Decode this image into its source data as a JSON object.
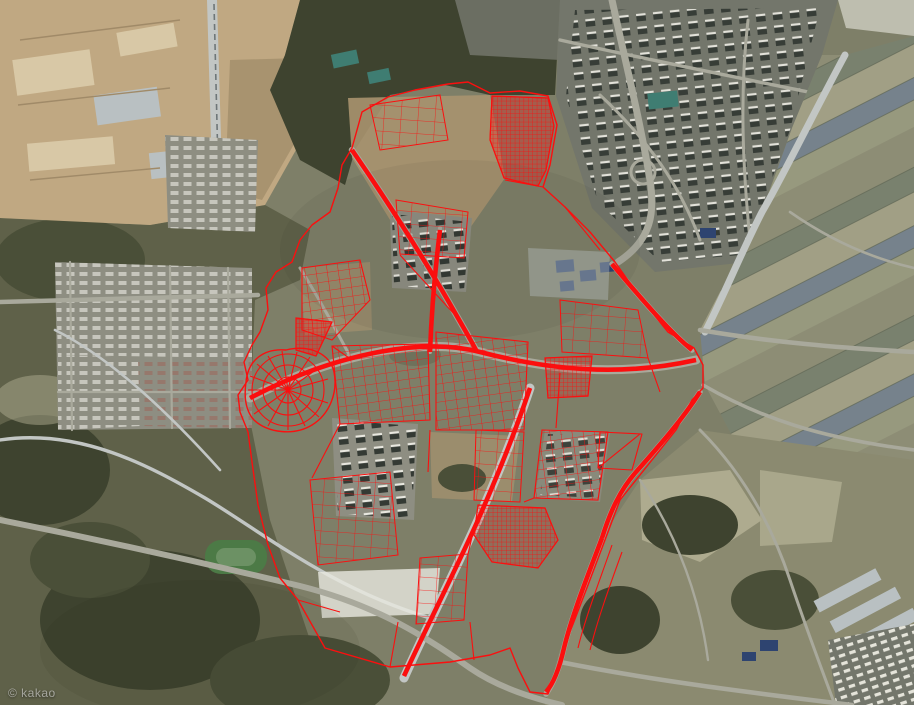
{
  "map": {
    "view_type": "satellite-aerial",
    "watermark": "© kakao",
    "description": "Satellite map of a Korean new-town development district with a red cadastral parcel-boundary overlay",
    "zoom_scale_px": [
      914,
      705
    ],
    "colors": {
      "base": "#7e7f68",
      "forest": "#3e432f",
      "forest2": "#4a4f38",
      "rural": "#5f6149",
      "dirt": "#c0a882",
      "dirt_light": "#d8c8a6",
      "pad_gray": "#b9c0c2",
      "dirt_deep": "#a8936f",
      "urban": "#73766b",
      "urban_light": "#8e8e82",
      "road": "#a9a99c",
      "road_light": "#c2c6c4",
      "field": "#8d8d75",
      "field_dark": "#79816e",
      "field_tan": "#a19f85",
      "field_blue": "#76828c",
      "farmland": "#8b8a70",
      "terrace": "#aeab8f",
      "building_dark": "#343a34",
      "building_white": "#e9e8e0",
      "roof_blue": "#2e4470",
      "roof_teal": "#3f7d72",
      "green_field": "#4c7a46",
      "overlay_red": "#fb0f0f"
    }
  },
  "overlay": {
    "name": "cadastral-parcel-boundaries",
    "color": "#fb0f0f",
    "style": "thin red outlines with dense subdivision grids and double-line road edges",
    "dense_blocks": [
      "northeast-grid",
      "west-fan-radial",
      "west-triangle",
      "central-grid",
      "south-grid"
    ]
  },
  "landmarks": {
    "northwest": "large earthworks / construction site (tan graded terrain)",
    "north_center": "dark forested hill",
    "northeast": "dense apartment-complex urban area",
    "east": "striped agricultural fields with diagonal highway",
    "southwest": "dark rural hills with winding roads and sports field",
    "southeast": "farmland, greenhouses and small housing estate",
    "center": "new-town construction zone outlined by red parcel overlay"
  }
}
